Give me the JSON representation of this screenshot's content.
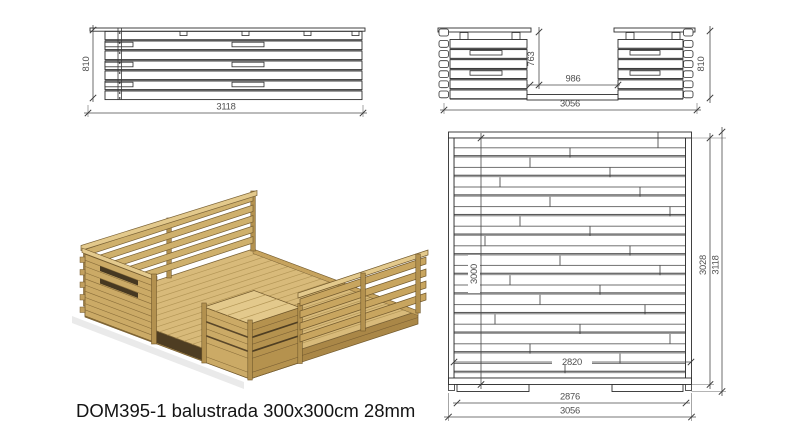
{
  "caption": "DOM395-1 balustrada 300x300cm 28mm",
  "dims": {
    "front": {
      "width": "3118",
      "height": "810"
    },
    "entry": {
      "width": "3056",
      "height": "810",
      "opening_width": "986",
      "opening_height": "763"
    },
    "plan": {
      "width": "3056",
      "feet_width": "2876",
      "board_span": "2820",
      "height": "3118",
      "inner_height": "3028",
      "deck_depth": "3000"
    }
  },
  "colors": {
    "wood_top": "#e3c98c",
    "wood_face": "#cbaa66",
    "wood_side": "#b5924e",
    "drawing_line": "#2e2e2e",
    "dim_text": "#4f4f4f",
    "gap_gray": "#9c9c9c"
  }
}
